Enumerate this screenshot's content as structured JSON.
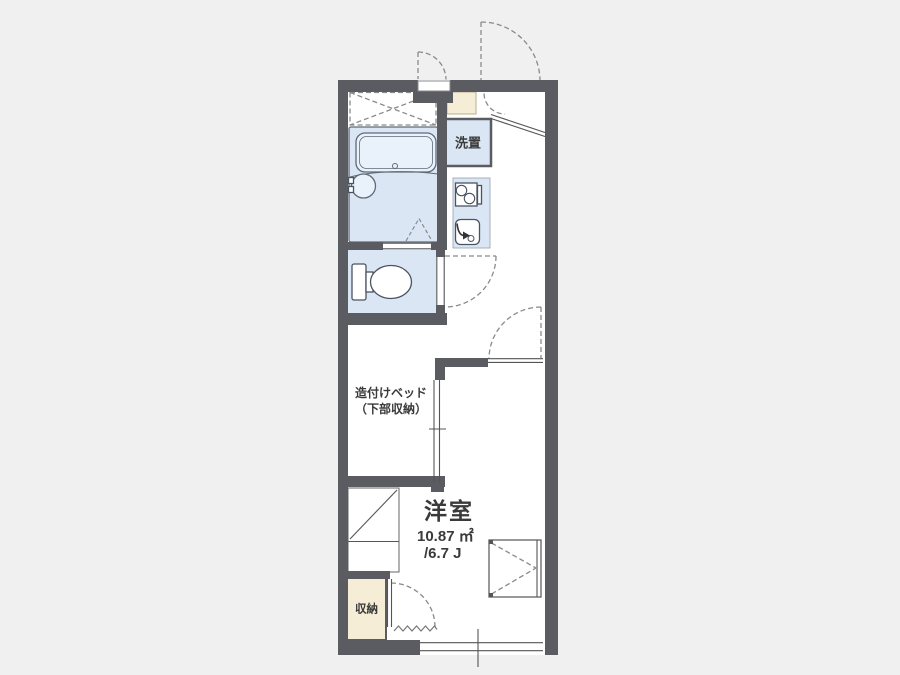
{
  "title": "apartment-floorplan",
  "colors": {
    "background": "#f0f0f0",
    "floor": "#ffffff",
    "wall": "#5b5b62",
    "fixture_fill": "#dbe6f4",
    "fixture_light": "#e9f1fa",
    "fixture_stroke": "#5f6a78",
    "fixture_dark": "#4a5360",
    "cream": "#f6edd6",
    "cream_border": "#b9ac8d",
    "line": "#555555",
    "dash": "#8a8a8a",
    "zigzag": "#777777",
    "text": "#3a3a3a"
  },
  "labels": {
    "washer": "洗置",
    "bed_line1": "造付けベッド",
    "bed_line2": "（下部収納）",
    "room": "洋室",
    "area_sqm": "10.87 ㎡",
    "area_jo": "/6.7 J",
    "storage": "収納"
  }
}
